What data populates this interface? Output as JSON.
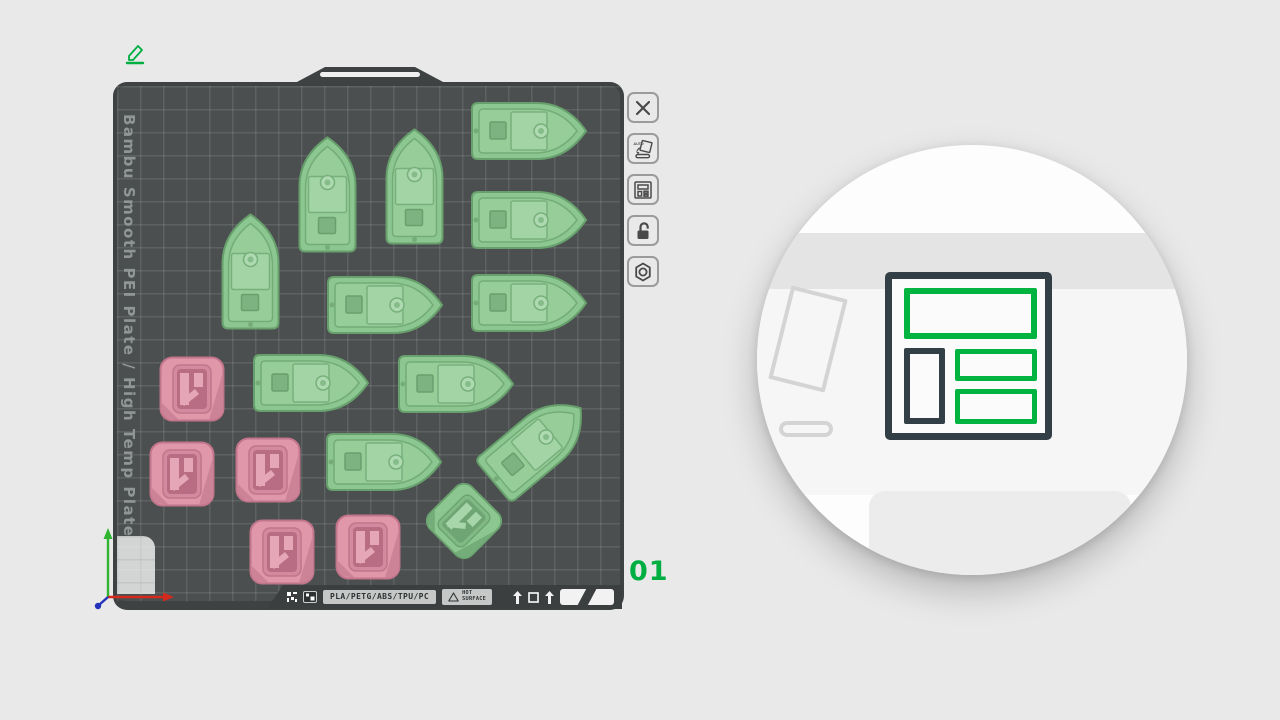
{
  "header": {
    "edit_icon": "pencil-icon"
  },
  "plate": {
    "name_vertical": "Bambu Smooth PEI Plate / High Temp Plate",
    "number": "01",
    "footer": {
      "filaments": "PLA/PETG/ABS/TPU/PC",
      "warning_line1": "HOT",
      "warning_line2": "SURFACE"
    }
  },
  "toolbar": {
    "items": [
      {
        "id": "close-plate",
        "icon": "close-icon"
      },
      {
        "id": "auto-orient",
        "icon": "auto-orient-icon",
        "label": "AUTO"
      },
      {
        "id": "arrange-plate",
        "icon": "arrange-icon"
      },
      {
        "id": "lock-plate",
        "icon": "lock-open-icon"
      },
      {
        "id": "plate-settings",
        "icon": "plate-settings-icon"
      }
    ]
  },
  "magnifier": {
    "focus_icon": "arrange-icon",
    "accent_color": "#00b43f",
    "frame_color": "#333f47"
  },
  "colors": {
    "accent_green": "#00ae42",
    "plate": "#4b4f4f",
    "grid_line": "rgba(255,255,255,0.10)",
    "model_green": "#8cc690",
    "model_pink": "#df97a9",
    "axis_x": "#d42a1e",
    "axis_y": "#2fb52f",
    "axis_z": "#2233bb"
  },
  "scene": {
    "objects": [
      {
        "kind": "benchy-boat",
        "variant": "boat",
        "color": "green",
        "cx": 411,
        "cy": 45,
        "w": 123,
        "h": 62,
        "rot": 0
      },
      {
        "kind": "benchy-boat",
        "variant": "boat",
        "color": "green",
        "cx": 411,
        "cy": 134,
        "w": 123,
        "h": 62,
        "rot": 0
      },
      {
        "kind": "benchy-boat",
        "variant": "boat",
        "color": "green",
        "cx": 411,
        "cy": 217,
        "w": 123,
        "h": 62,
        "rot": 0
      },
      {
        "kind": "benchy-boat",
        "variant": "boat",
        "color": "green",
        "cx": 267,
        "cy": 219,
        "w": 123,
        "h": 62,
        "rot": 0
      },
      {
        "kind": "benchy-boat",
        "variant": "boat",
        "color": "green",
        "cx": 193,
        "cy": 297,
        "w": 123,
        "h": 62,
        "rot": 0
      },
      {
        "kind": "benchy-boat",
        "variant": "boat",
        "color": "green",
        "cx": 338,
        "cy": 298,
        "w": 123,
        "h": 62,
        "rot": 0
      },
      {
        "kind": "benchy-boat",
        "variant": "boat",
        "color": "green",
        "cx": 266,
        "cy": 376,
        "w": 123,
        "h": 62,
        "rot": 0
      },
      {
        "kind": "benchy-boat",
        "variant": "boat",
        "color": "green",
        "cx": 210,
        "cy": 109,
        "w": 123,
        "h": 62,
        "rot": -90
      },
      {
        "kind": "benchy-boat",
        "variant": "boat",
        "color": "green",
        "cx": 297,
        "cy": 101,
        "w": 123,
        "h": 62,
        "rot": -90
      },
      {
        "kind": "benchy-boat",
        "variant": "boat",
        "color": "green",
        "cx": 133,
        "cy": 186,
        "w": 123,
        "h": 62,
        "rot": -90
      },
      {
        "kind": "benchy-boat",
        "variant": "boat",
        "color": "green",
        "cx": 419,
        "cy": 359,
        "w": 123,
        "h": 62,
        "rot": -40
      },
      {
        "kind": "calibration-cube",
        "variant": "cube",
        "color": "pink",
        "cx": 75,
        "cy": 303,
        "w": 66,
        "h": 66,
        "rot": 0
      },
      {
        "kind": "calibration-cube",
        "variant": "cube",
        "color": "pink",
        "cx": 65,
        "cy": 388,
        "w": 66,
        "h": 66,
        "rot": 0
      },
      {
        "kind": "calibration-cube",
        "variant": "cube",
        "color": "pink",
        "cx": 151,
        "cy": 384,
        "w": 66,
        "h": 66,
        "rot": 0
      },
      {
        "kind": "calibration-cube",
        "variant": "cube",
        "color": "pink",
        "cx": 165,
        "cy": 466,
        "w": 66,
        "h": 66,
        "rot": 0
      },
      {
        "kind": "calibration-cube",
        "variant": "cube",
        "color": "pink",
        "cx": 251,
        "cy": 461,
        "w": 66,
        "h": 66,
        "rot": 0
      },
      {
        "kind": "calibration-cube",
        "variant": "cube",
        "color": "green",
        "cx": 347,
        "cy": 435,
        "w": 62,
        "h": 62,
        "rot": 45
      }
    ]
  }
}
